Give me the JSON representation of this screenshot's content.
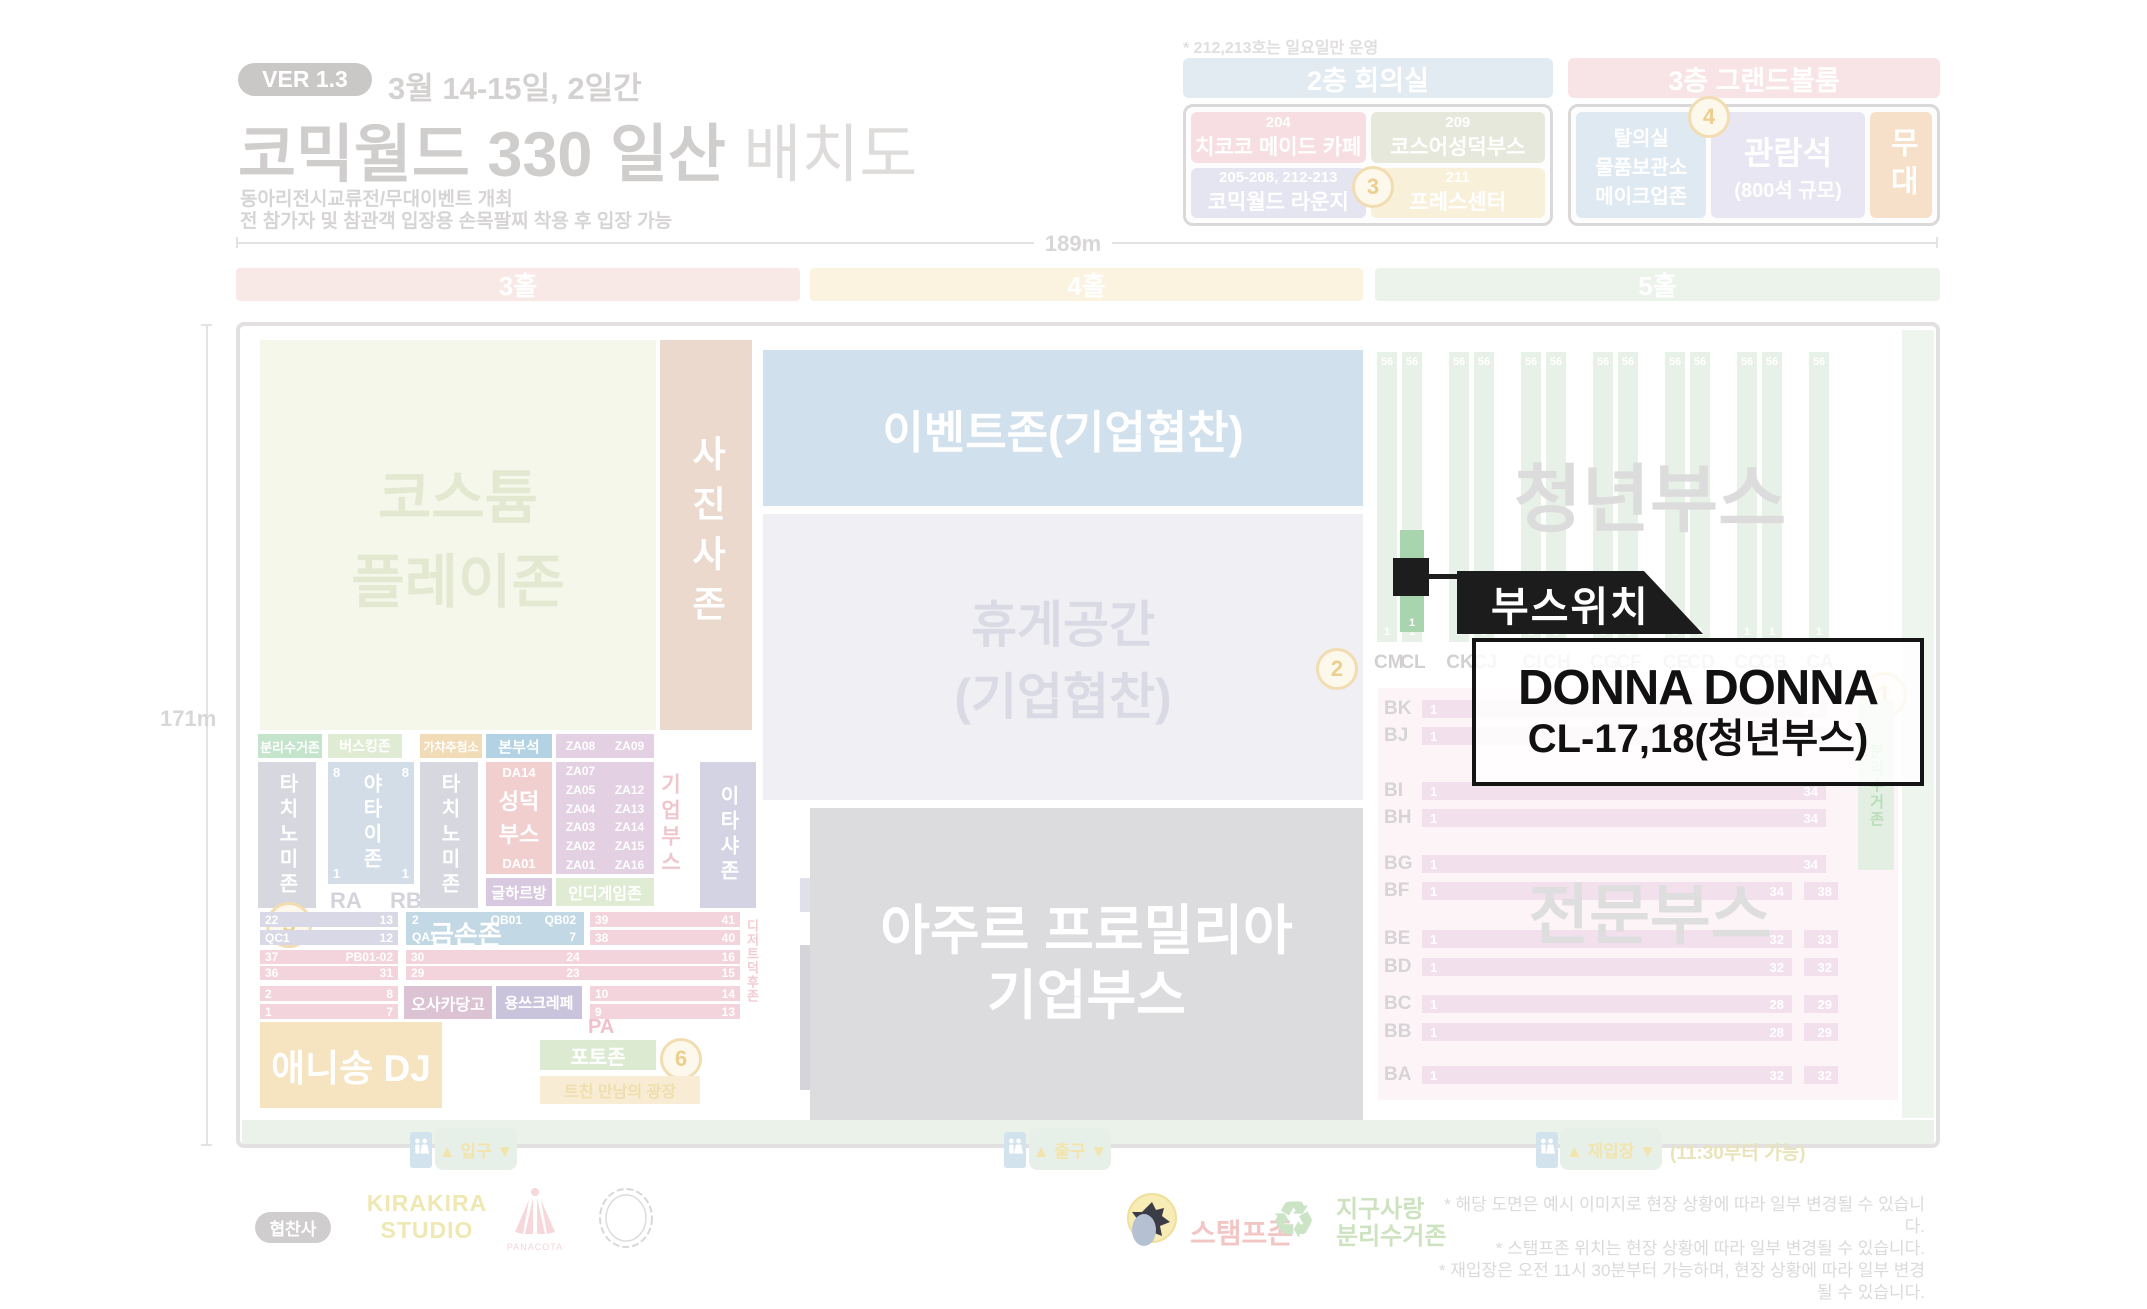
{
  "header": {
    "version_badge": "VER 1.3",
    "date_range": "3월 14-15일, 2일간",
    "title_main": "코믹월드 330 일산",
    "title_suffix": "배치도",
    "subtitle_line1": "동아리전시교류전/무대이벤트 개최",
    "subtitle_line2": "전 참가자 및 참관객 입장용 손목팔찌 착용 후 입장 가능"
  },
  "floor2": {
    "note": "* 212,213호는 일요일만 운영",
    "title": "2층 회의실",
    "badge": "3",
    "rooms": [
      {
        "number": "204",
        "name": "치코코 메이드 카페"
      },
      {
        "number": "209",
        "name": "코스어성덕부스"
      },
      {
        "number": "205-208, 212-213",
        "name": "코믹월드 라운지"
      },
      {
        "number": "211",
        "name": "프레스센터"
      }
    ]
  },
  "floor3": {
    "title": "3층 그랜드볼룸",
    "badge": "4",
    "room_line1": "탈의실",
    "room_line2": "물품보관소",
    "room_line3": "메이크업존",
    "seating": "관람석",
    "seating_sub": "(800석 규모)",
    "stage": "무대"
  },
  "dims": {
    "width_label": "189m",
    "height_label": "171m"
  },
  "halls": [
    {
      "label": "3홀"
    },
    {
      "label": "4홀"
    },
    {
      "label": "5홀"
    }
  ],
  "hall3": {
    "costume_line1": "코스튬",
    "costume_line2": "플레이존",
    "photo_zone": "사진사존",
    "recycle": "분리수거존",
    "busking": "버스킹존",
    "gacha": "가챠추첨소",
    "hq": "본부석",
    "za_top_left": "ZA08",
    "za_top_right": "ZA09",
    "tachinomi": "타치노미존",
    "yatai": "야타이존",
    "yatai_tl": "8",
    "yatai_tr": "8",
    "yatai_bl": "1",
    "yatai_br": "1",
    "ra": "RA",
    "rb": "RB",
    "da_top": "DA14",
    "seongdeok_line1": "성덕",
    "seongdeok_line2": "부스",
    "da_bottom": "DA01",
    "za_left": [
      "ZA07",
      "ZA05",
      "ZA04",
      "ZA03",
      "ZA02",
      "ZA01"
    ],
    "za_right": [
      "ZA12",
      "ZA13",
      "ZA14",
      "ZA15",
      "ZA16"
    ],
    "golharbang": "글하르방",
    "indie_zone": "인디게임존",
    "corp_vertical": "기업부스",
    "itasha": "이타샤존",
    "dessert_vertical": "디저트덕후존",
    "circle5": "5",
    "bars": {
      "b1l": "22",
      "b1r": "13",
      "b2l": "QC1",
      "b2r": "12",
      "gold_label": "금손존",
      "g1l": "2",
      "g1r1": "QB01",
      "g1r2": "QB02",
      "g2l": "QA1",
      "g2r": "7",
      "p1l": "39",
      "p1r": "41",
      "p2l": "38",
      "p2r": "40",
      "f1": "37",
      "f2": "PB01-02",
      "f3": "30",
      "f4": "24",
      "f5": "16",
      "gg1": "36",
      "gg2": "31",
      "gg3": "29",
      "gg4": "23",
      "gg5": "15",
      "h1l": "2",
      "h1r": "8",
      "h2l": "1",
      "h2r": "7",
      "osaka": "오사카당고",
      "crepe": "용쓰크레페",
      "r1l": "10",
      "r1r": "14",
      "r2l": "9",
      "r2r": "13"
    },
    "anisong": "애니송 DJ",
    "pa": "PA",
    "photozone": "포토존",
    "circle6": "6",
    "tchin": "트친 만남의 광장"
  },
  "hall4": {
    "event_zone": "이벤트존(기업협찬)",
    "rest_line1": "휴게공간",
    "rest_line2": "(기업협찬)",
    "circle2": "2",
    "azure_line1": "아주르 프로밀리아",
    "azure_line2": "기업부스"
  },
  "hall5": {
    "youth_title": "청년부스",
    "pro_title": "전문부스",
    "circle1": "1",
    "recycle_vertical": "분리수거존",
    "columns": [
      {
        "label": "CM",
        "top": "56",
        "bottom": "1"
      },
      {
        "label": "CL",
        "top": "56",
        "bottom": "1"
      },
      {
        "label": "CK",
        "top": "56",
        "bottom": "1"
      },
      {
        "label": "CJ",
        "top": "56",
        "bottom": "1"
      },
      {
        "label": "CI",
        "top": "56",
        "bottom": "1"
      },
      {
        "label": "CH",
        "top": "56",
        "bottom": "1"
      },
      {
        "label": "CG",
        "top": "56",
        "bottom": "1"
      },
      {
        "label": "CF",
        "top": "56",
        "bottom": "1"
      },
      {
        "label": "CE",
        "top": "56",
        "bottom": "1"
      },
      {
        "label": "CD",
        "top": "56",
        "bottom": "1"
      },
      {
        "label": "CC",
        "top": "56",
        "bottom": "1"
      },
      {
        "label": "CB",
        "top": "56",
        "bottom": "1"
      },
      {
        "label": "CA",
        "top": "56",
        "bottom": "1"
      }
    ],
    "rows": [
      {
        "label": "BK",
        "start": "1",
        "end": "34",
        "extra": ""
      },
      {
        "label": "BJ",
        "start": "1",
        "end": "34",
        "extra": ""
      },
      {
        "label": "BI",
        "start": "1",
        "end": "34",
        "extra": ""
      },
      {
        "label": "BH",
        "start": "1",
        "end": "34",
        "extra": ""
      },
      {
        "label": "BG",
        "start": "1",
        "end": "34",
        "extra": ""
      },
      {
        "label": "BF",
        "start": "1",
        "end": "34",
        "extra": "38"
      },
      {
        "label": "BE",
        "start": "1",
        "end": "32",
        "extra": "33"
      },
      {
        "label": "BD",
        "start": "1",
        "end": "32",
        "extra": "32"
      },
      {
        "label": "BC",
        "start": "1",
        "end": "28",
        "extra": "29"
      },
      {
        "label": "BB",
        "start": "1",
        "end": "28",
        "extra": "29"
      },
      {
        "label": "BA",
        "start": "1",
        "end": "32",
        "extra": "32"
      }
    ]
  },
  "callout": {
    "banner": "부스위치",
    "name": "DONNA DONNA",
    "location": "CL-17,18(청년부스)"
  },
  "footer": {
    "entrance": "▲ 입구 ▼",
    "exit": "▲ 출구 ▼",
    "reentry": "▲ 재입장 ▼",
    "reentry_note": "(11:30부터 가능)",
    "sponsor_label": "협찬사",
    "sponsor1_line1": "KIRAKIRA",
    "sponsor1_line2": "STUDIO",
    "sponsor2": "PANACOTA",
    "stamp": "스탬프존",
    "recycle_symbol": "♻",
    "earth_line1": "지구사랑",
    "earth_line2": "분리수거존",
    "notes": [
      "* 해당 도면은 예시 이미지로 현장 상황에 따라 일부 변경될 수 있습니다.",
      "* 스탬프존 위치는 현장 상황에 따라 일부 변경될 수 있습니다.",
      "* 재입장은 오전 11시 30분부터 가능하며, 현장 상황에 따라 일부 변경될 수 있습니다."
    ]
  },
  "colors": {
    "highlight_green": "#a9d5ae",
    "marker_black": "#1d1d1d"
  }
}
